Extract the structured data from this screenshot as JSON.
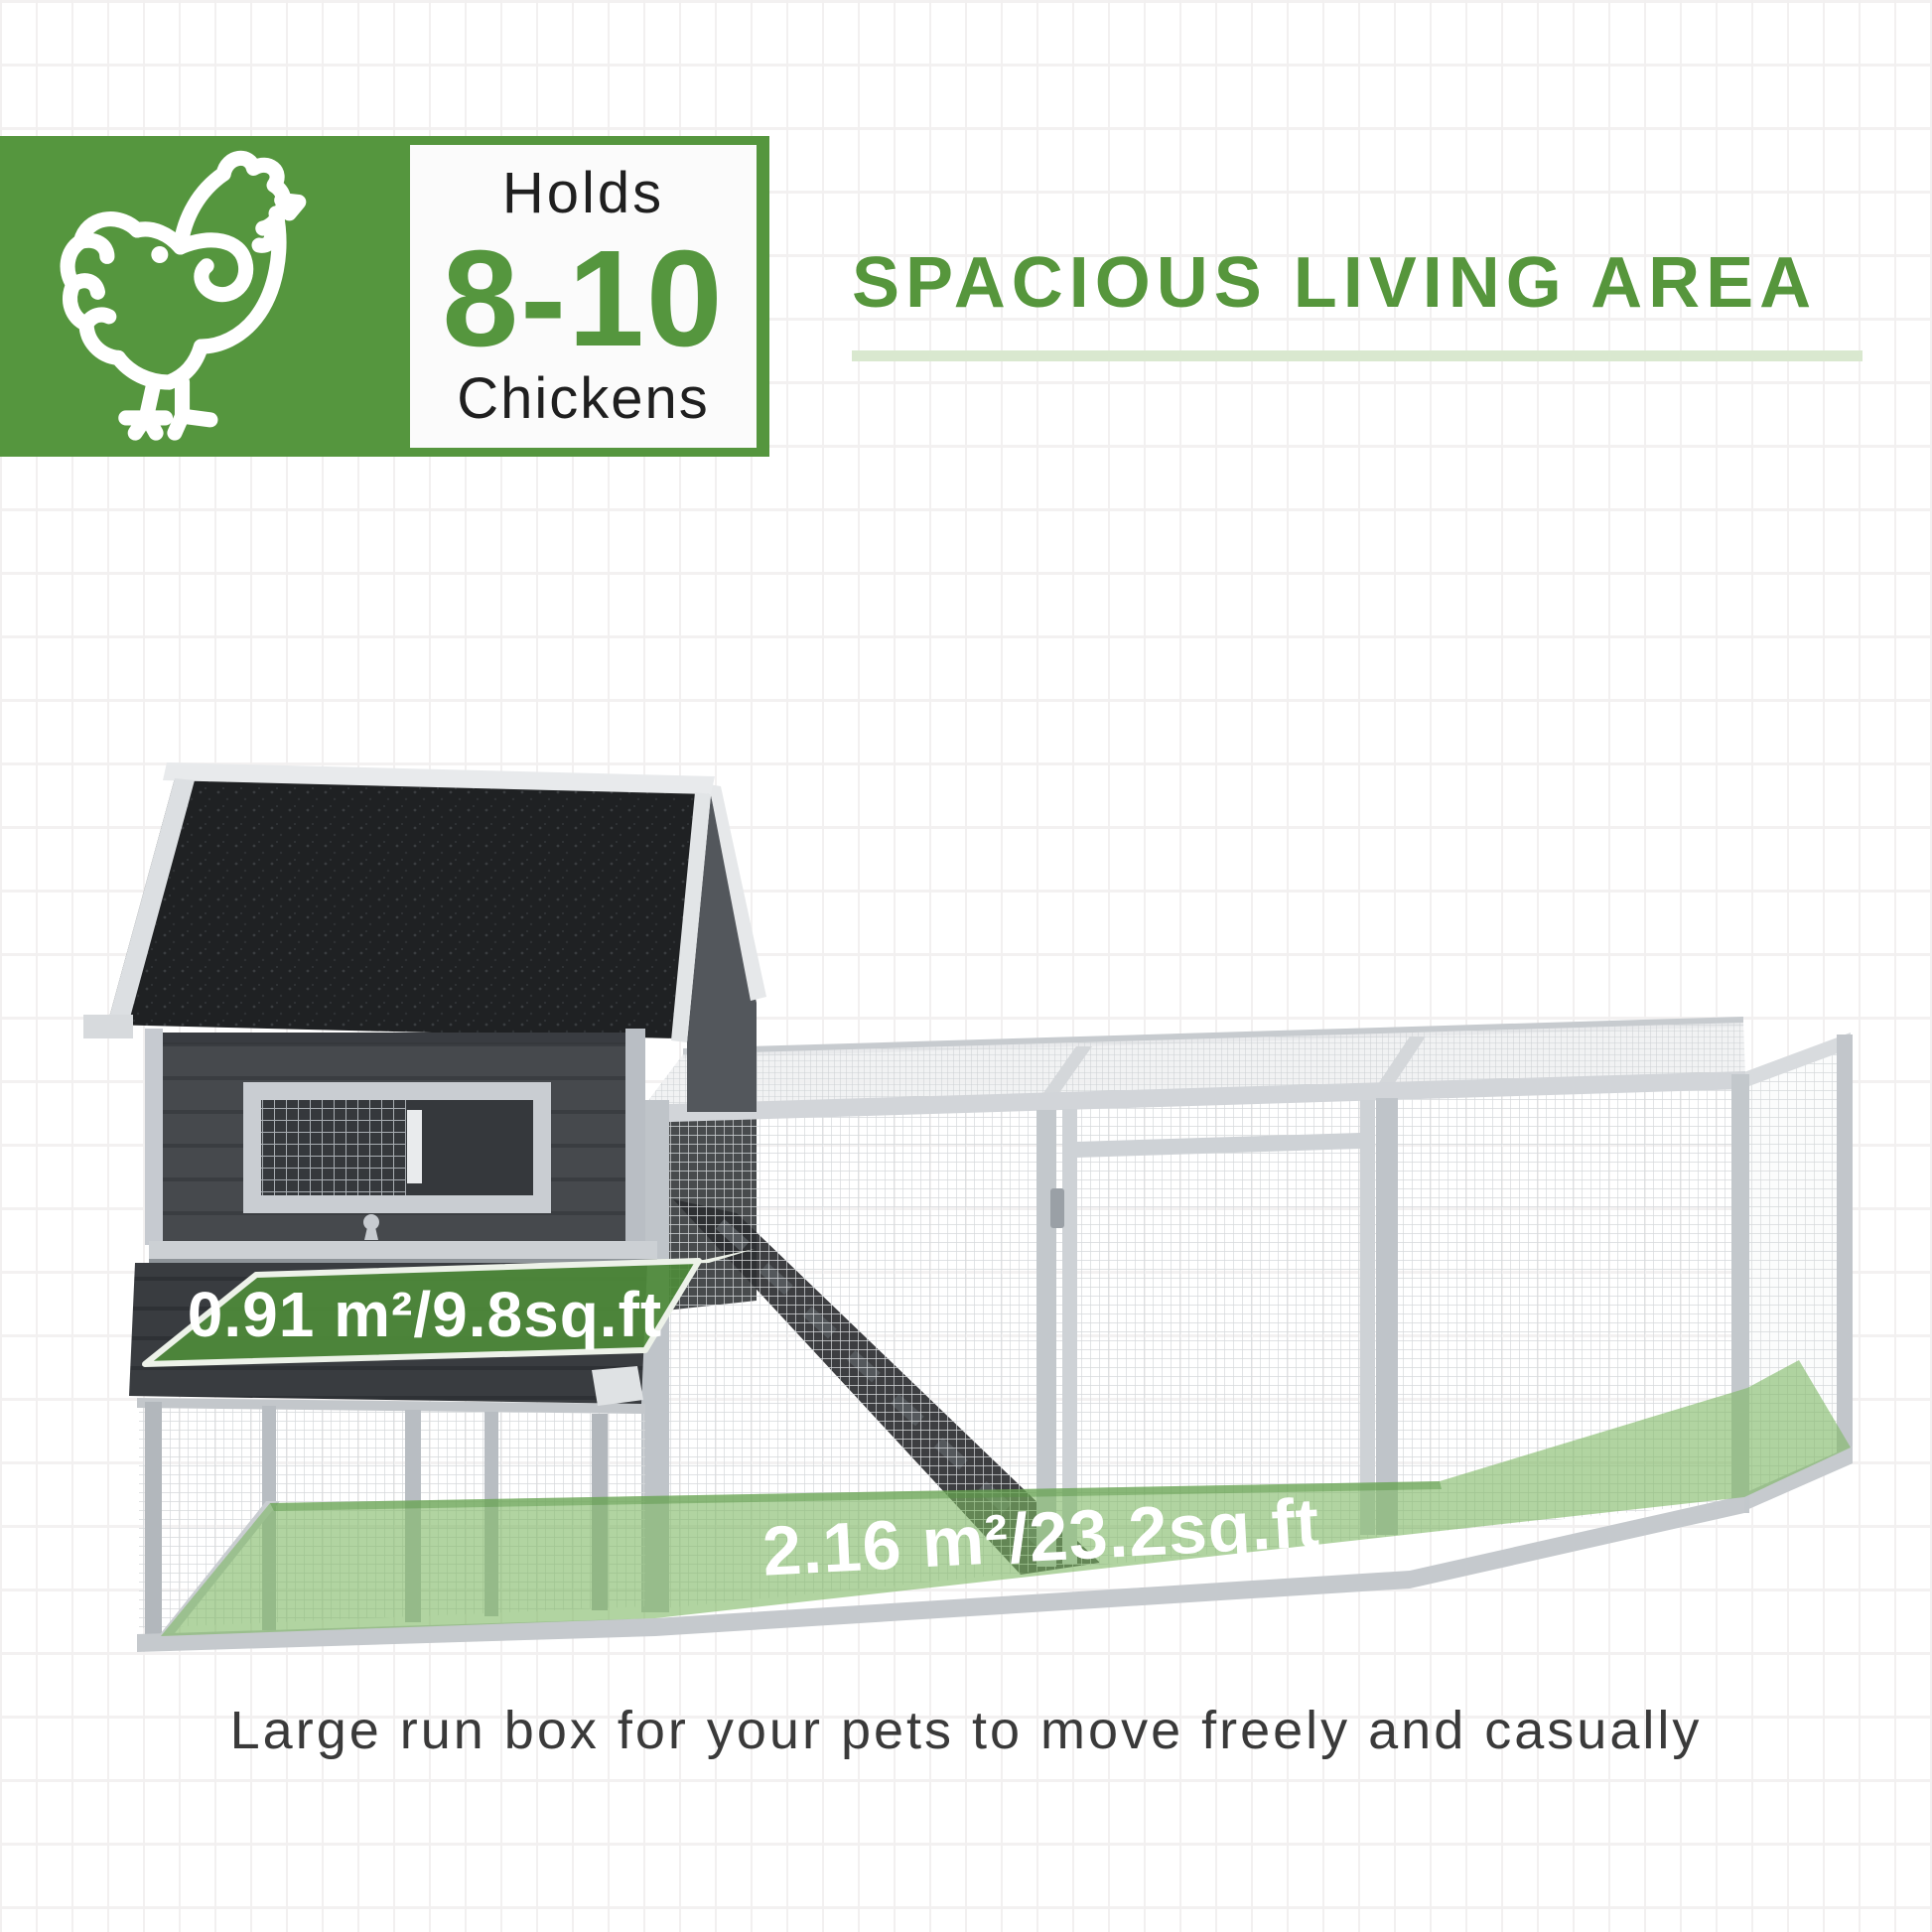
{
  "badge": {
    "holds_label": "Holds",
    "capacity": "8-10",
    "capacity_unit": "Chickens"
  },
  "heading": {
    "title": "SPACIOUS LIVING AREA"
  },
  "overlays": {
    "coop_area": "0.91 m²/9.8sq.ft",
    "run_area": "2.16 m²/23.2sq.ft"
  },
  "caption": {
    "text": "Large run box for your pets to move freely and casually"
  },
  "colors": {
    "brand_green": "#55963e",
    "label_green": "#4e8a3a",
    "floor_green": "#7db763",
    "underline_green": "#d9e8cf",
    "roof_black": "#1f2123",
    "wall_charcoal": "#46494d",
    "frame_gray": "#ccd0d4"
  }
}
